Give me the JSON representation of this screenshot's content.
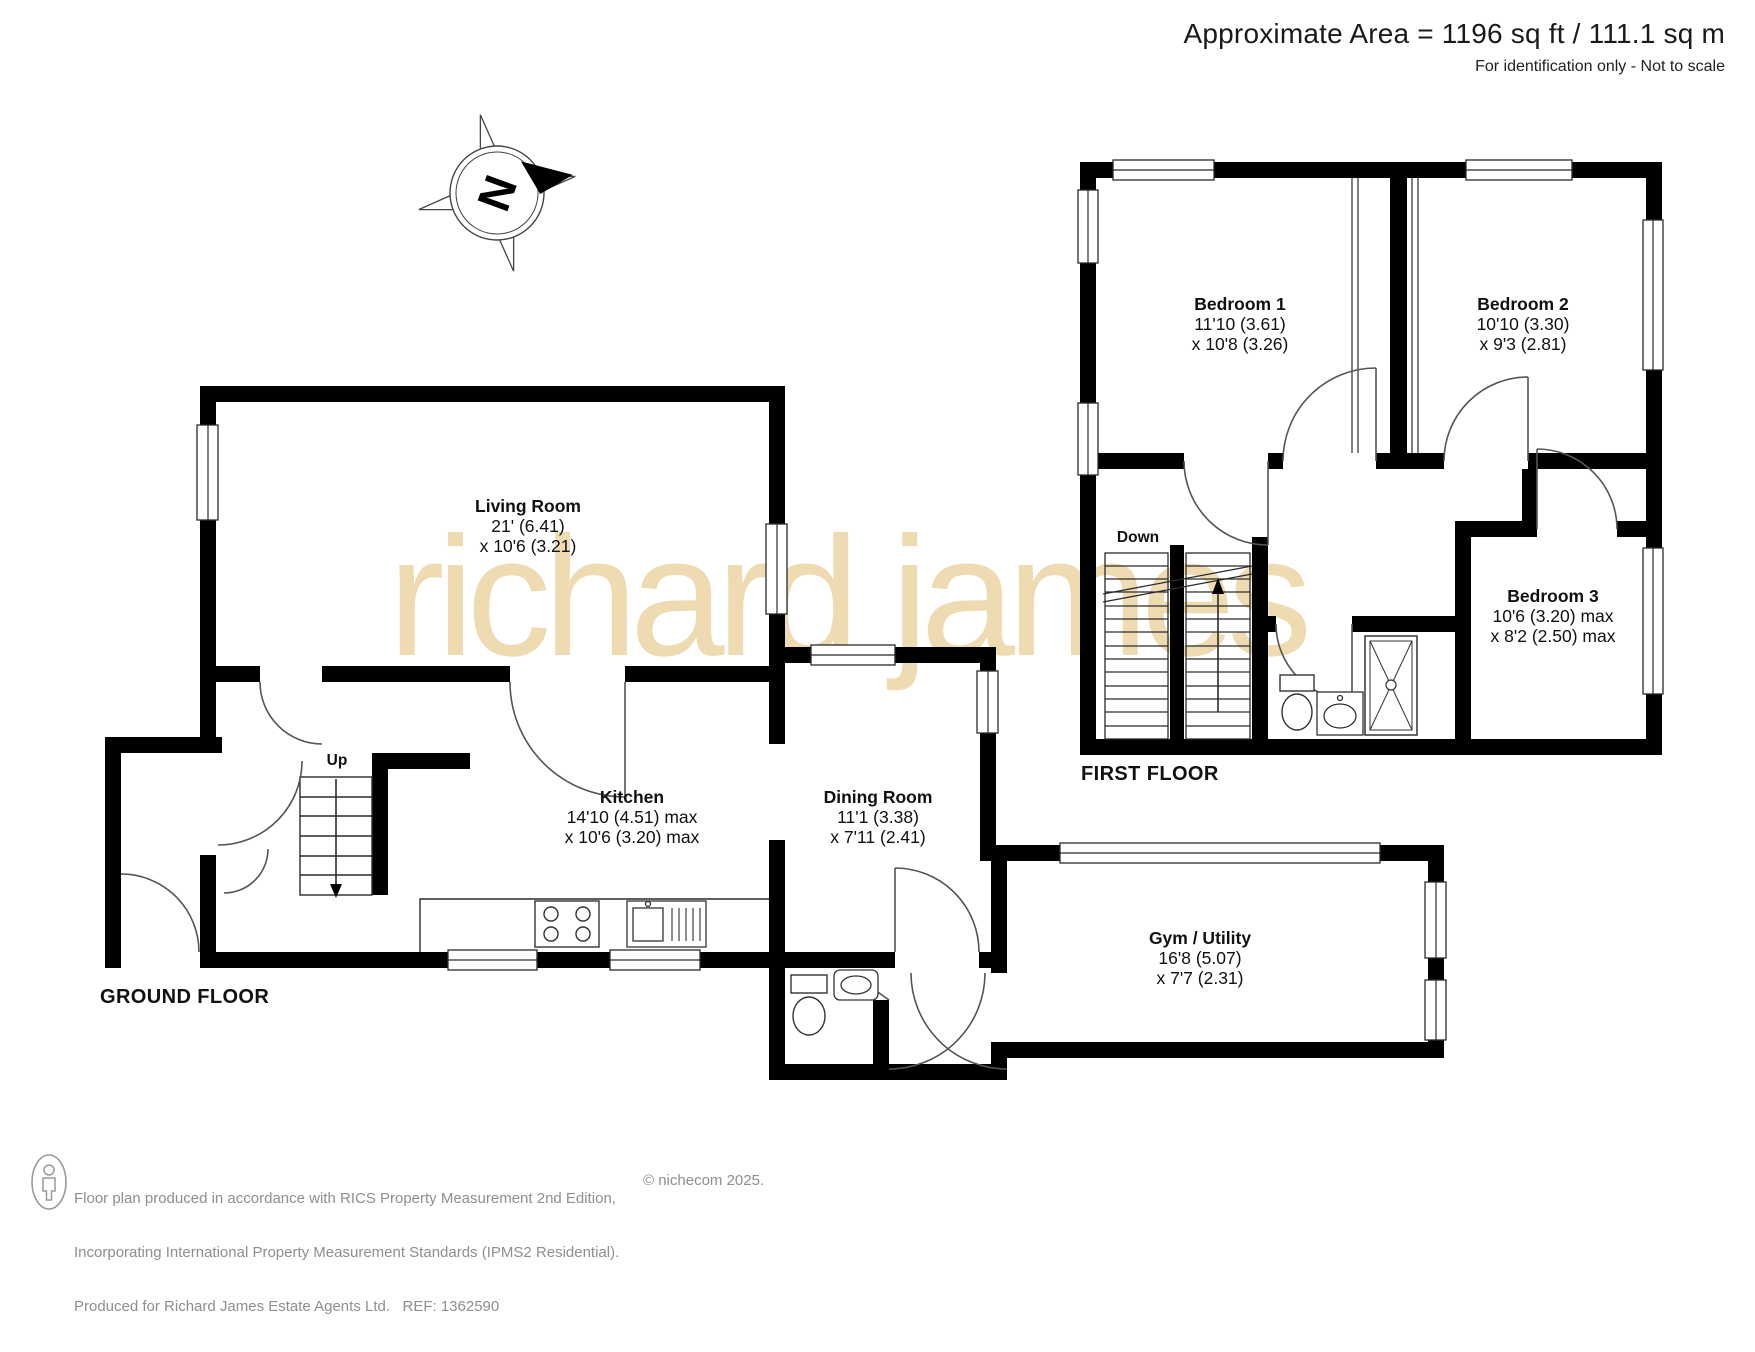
{
  "header": {
    "area_text": "Approximate Area = 1196 sq ft / 111.1 sq m",
    "disclaimer": "For identification only - Not to scale"
  },
  "watermark": "richard james",
  "compass": {
    "label": "N"
  },
  "floors": {
    "ground": {
      "label": "GROUND FLOOR",
      "stairs_label": "Up"
    },
    "first": {
      "label": "FIRST FLOOR",
      "stairs_label": "Down"
    }
  },
  "rooms": [
    {
      "id": "living-room",
      "name": "Living Room",
      "dim1": "21' (6.41)",
      "dim2": "x 10'6 (3.21)"
    },
    {
      "id": "kitchen",
      "name": "Kitchen",
      "dim1": "14'10 (4.51) max",
      "dim2": "x 10'6 (3.20) max"
    },
    {
      "id": "dining-room",
      "name": "Dining Room",
      "dim1": "11'1 (3.38)",
      "dim2": "x 7'11 (2.41)"
    },
    {
      "id": "gym-utility",
      "name": "Gym / Utility",
      "dim1": "16'8 (5.07)",
      "dim2": "x 7'7 (2.31)"
    },
    {
      "id": "bedroom-1",
      "name": "Bedroom 1",
      "dim1": "11'10 (3.61)",
      "dim2": "x 10'8 (3.26)"
    },
    {
      "id": "bedroom-2",
      "name": "Bedroom 2",
      "dim1": "10'10 (3.30)",
      "dim2": "x 9'3 (2.81)"
    },
    {
      "id": "bedroom-3",
      "name": "Bedroom 3",
      "dim1": "10'6 (3.20) max",
      "dim2": "x 8'2 (2.50) max"
    }
  ],
  "footer": {
    "line1": "Floor plan produced in accordance with RICS Property Measurement 2nd Edition,",
    "line2": "Incorporating International Property Measurement Standards (IPMS2 Residential).",
    "copyright": "© nichecom 2025.",
    "line3": "Produced for Richard James Estate Agents Ltd.   REF: 1362590"
  },
  "colors": {
    "wall": "#000000",
    "watermark": "#edd8ab",
    "footer_text": "#8f8f8f"
  }
}
